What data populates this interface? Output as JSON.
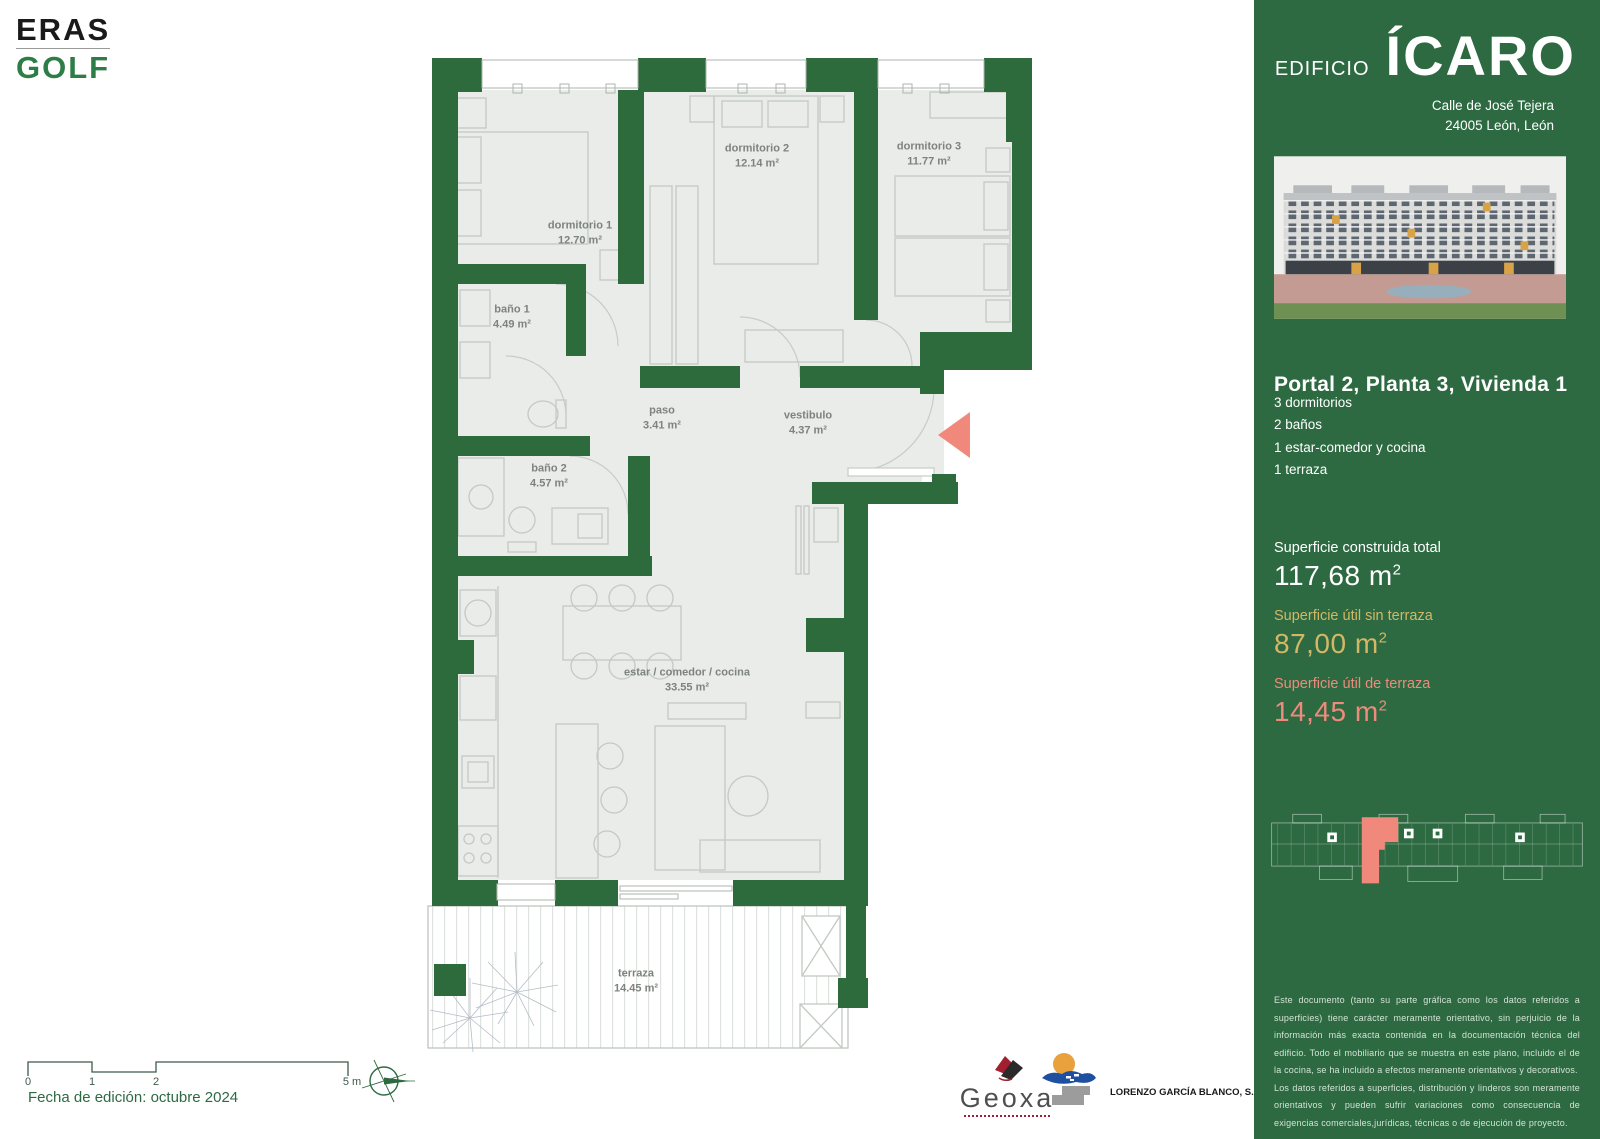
{
  "brand": {
    "line1": "ERAS",
    "line2": "GOLF"
  },
  "sidebar": {
    "building_label": "EDIFICIO",
    "building_name": "ÍCARO",
    "address_line1": "Calle de José Tejera",
    "address_line2": "24005 León, León",
    "unit_title": "Portal 2, Planta 3, Vivienda 1",
    "features": [
      "3 dormitorios",
      "2 baños",
      "1 estar-comedor y cocina",
      "1 terraza"
    ],
    "surfaces": [
      {
        "label": "Superficie construida total",
        "value": "117,68 m",
        "exp": "2",
        "color": "#ffffff"
      },
      {
        "label": "Superficie útil sin terraza",
        "value": "87,00 m",
        "exp": "2",
        "color": "#d4b766"
      },
      {
        "label": "Superficie útil de terraza",
        "value": "14,45 m",
        "exp": "2",
        "color": "#ef8b7d"
      }
    ],
    "disclaimer_p1": "Este documento (tanto su parte gráfica como los datos referidos a superficies) tiene carácter meramente orientativo, sin perjuicio de la información más exacta contenida en la documentación técnica del edificio. Todo el mobiliario que se muestra en este plano, incluido el de la cocina, se ha incluido a efectos meramente orientativos y decorativos.",
    "disclaimer_p2": "Los datos referidos a superficies, distribución y linderos son meramente orientativos y pueden sufrir variaciones como consecuencia de exigencias comerciales,jurídicas, técnicas o de ejecución de proyecto."
  },
  "plan": {
    "rooms": [
      {
        "name": "dormitorio 1",
        "area": "12.70 m²"
      },
      {
        "name": "dormitorio 2",
        "area": "12.14 m²"
      },
      {
        "name": "dormitorio 3",
        "area": "11.77 m²"
      },
      {
        "name": "baño 1",
        "area": "4.49 m²"
      },
      {
        "name": "baño 2",
        "area": "4.57 m²"
      },
      {
        "name": "paso",
        "area": "3.41 m²"
      },
      {
        "name": "vestibulo",
        "area": "4.37 m²"
      },
      {
        "name": "estar / comedor / cocina",
        "area": "33.55 m²"
      },
      {
        "name": "terraza",
        "area": "14.45 m²"
      }
    ]
  },
  "footer": {
    "scale_ticks": [
      "0",
      "1",
      "2",
      "5 m"
    ],
    "edition": "Fecha de edición: octubre 2024",
    "geoxa_label": "Geoxa",
    "lgb_label": "LORENZO GARCÍA BLANCO, S.L."
  },
  "colors": {
    "green": "#2d6a41",
    "wall": "#2e6b3c",
    "salmon": "#ef8b7d",
    "gold": "#d4b766",
    "floor": "#e9ece8"
  }
}
